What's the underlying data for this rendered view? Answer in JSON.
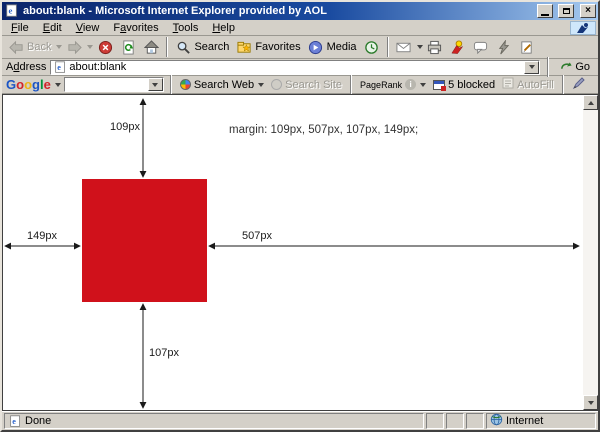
{
  "window": {
    "title": "about:blank - Microsoft Internet Explorer provided by AOL"
  },
  "menu": {
    "items": [
      {
        "label": "File",
        "u": 0
      },
      {
        "label": "Edit",
        "u": 0
      },
      {
        "label": "View",
        "u": 0
      },
      {
        "label": "Favorites",
        "u": 1
      },
      {
        "label": "Tools",
        "u": 0
      },
      {
        "label": "Help",
        "u": 0
      }
    ]
  },
  "toolbar": {
    "back": "Back",
    "search": "Search",
    "favorites": "Favorites",
    "media": "Media"
  },
  "address_bar": {
    "label": {
      "label": "Address",
      "u": 1
    },
    "value": "about:blank",
    "go": "Go"
  },
  "google_bar": {
    "logo_letters": [
      {
        "ch": "G",
        "c": "#1b55c5"
      },
      {
        "ch": "o",
        "c": "#d2232a"
      },
      {
        "ch": "o",
        "c": "#eeb211"
      },
      {
        "ch": "g",
        "c": "#1b55c5"
      },
      {
        "ch": "l",
        "c": "#00933b"
      },
      {
        "ch": "e",
        "c": "#d2232a"
      }
    ],
    "search_web": "Search Web",
    "search_site": "Search Site",
    "pagerank": "PageRank",
    "blocked": "5 blocked",
    "autofill": "AutoFill"
  },
  "page": {
    "margin_text": "margin: 109px, 507px, 107px,  149px;",
    "labels": {
      "top": "109px",
      "right": "507px",
      "bottom": "107px",
      "left": "149px"
    },
    "box_color": "#d0111b"
  },
  "status_bar": {
    "text": "Done",
    "zone": "Internet"
  }
}
